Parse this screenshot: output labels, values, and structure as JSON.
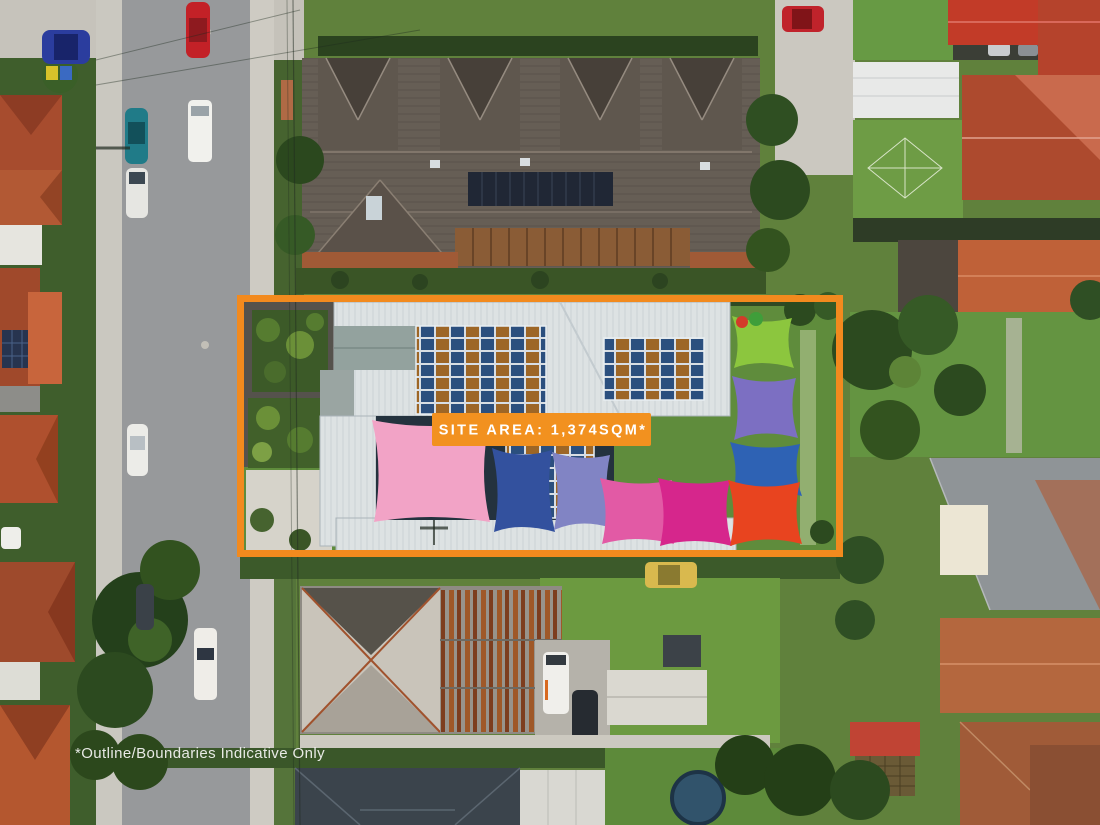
{
  "annotations": {
    "site_area_label": "SITE AREA: 1,374SQM*",
    "disclaimer": "*Outline/Boundaries Indicative Only"
  },
  "colors": {
    "boundary": "#F28A1E",
    "label_background": "#F2911F",
    "label_text": "#FFFFFF",
    "disclaimer_text": "#F2F2F0",
    "shade_sails": {
      "pink": "#F2A3C6",
      "navy": "#33519E",
      "periwinkle": "#8184C4",
      "magenta_light": "#E25AA5",
      "magenta": "#D6268C",
      "lime": "#8CC63E",
      "purple": "#7C6FC2",
      "blue": "#2E62B4",
      "red_orange": "#E8441F"
    },
    "solar_panel_blue": "#2B4F7E",
    "solar_panel_amber": "#9D6626"
  }
}
